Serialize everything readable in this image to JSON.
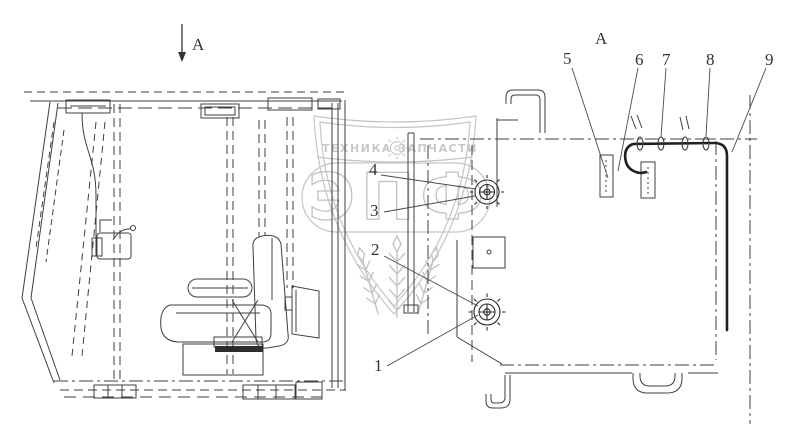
{
  "labels": {
    "section_arrow": "A",
    "view_title": "A"
  },
  "callouts": {
    "c1": "1",
    "c2": "2",
    "c3": "3",
    "c4": "4",
    "c5": "5",
    "c6": "6",
    "c7": "7",
    "c8": "8",
    "c9": "9"
  },
  "watermark": {
    "tagline_left": "ТЕХНИКА",
    "tagline_right": "ЗАПЧАСТИ",
    "brand": "ЭПФ",
    "gear_icon": "gear-icon",
    "wheat_icon": "wheat-ears-icon"
  },
  "colors": {
    "background": "#ffffff",
    "line": "#3f3f3f",
    "dark_line": "#1f1f1f",
    "watermark": "#bcbfc2",
    "text": "#333333"
  }
}
